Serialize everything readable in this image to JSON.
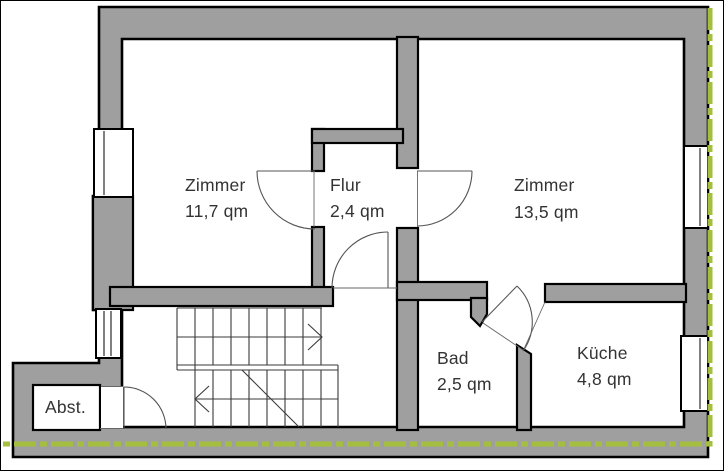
{
  "floor_plan": {
    "title": "Wohnungsgrundriss",
    "rooms": [
      {
        "id": "zimmer-1",
        "name": "Zimmer",
        "area": "11,7 qm"
      },
      {
        "id": "flur",
        "name": "Flur",
        "area": "2,4 qm"
      },
      {
        "id": "zimmer-2",
        "name": "Zimmer",
        "area": "13,5 qm"
      },
      {
        "id": "bad",
        "name": "Bad",
        "area": "2,5 qm"
      },
      {
        "id": "kueche",
        "name": "Küche",
        "area": "4,8 qm"
      },
      {
        "id": "abstellraum",
        "name": "Abst.",
        "area": ""
      }
    ],
    "features": {
      "stairs": "double flight with up/down arrows and break line",
      "doors": 5,
      "windows": 4
    },
    "colors": {
      "wall_fill": "#9f9f9f",
      "outline": "#000000",
      "section_line_green": "#a4bf3f",
      "background": "#ffffff",
      "text": "#333333"
    }
  }
}
